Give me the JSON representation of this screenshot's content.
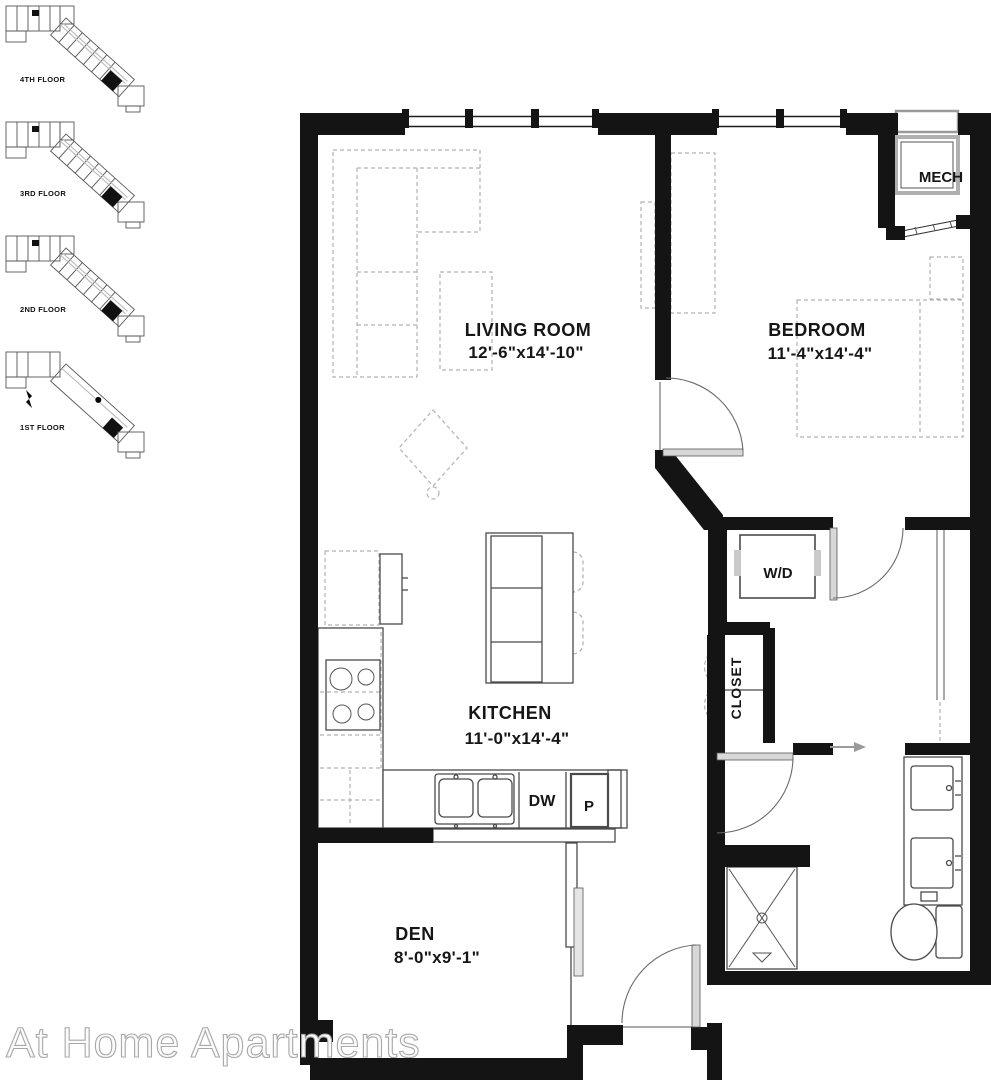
{
  "watermark": "At Home Apartments",
  "keyplans": [
    {
      "label": "4TH FLOOR"
    },
    {
      "label": "3RD FLOOR"
    },
    {
      "label": "2ND FLOOR"
    },
    {
      "label": "1ST FLOOR"
    }
  ],
  "rooms": {
    "living": {
      "name": "LIVING ROOM",
      "dims": "12'-6\"x14'-10\""
    },
    "bedroom": {
      "name": "BEDROOM",
      "dims": "11'-4\"x14'-4\""
    },
    "kitchen": {
      "name": "KITCHEN",
      "dims": "11'-0\"x14'-4\""
    },
    "den": {
      "name": "DEN",
      "dims": "8'-0\"x9'-1\""
    }
  },
  "labels": {
    "mech": "MECH",
    "washer_dryer": "W/D",
    "closet": "CLOSET",
    "dishwasher": "DW",
    "pantry": "P"
  },
  "colors": {
    "wall": "#141414",
    "fixture_line": "#4a4a4a",
    "furniture_dash": "#b2b2b2",
    "watermark_fill": "#fbfbfb",
    "watermark_stroke": "#a8a8a8"
  }
}
